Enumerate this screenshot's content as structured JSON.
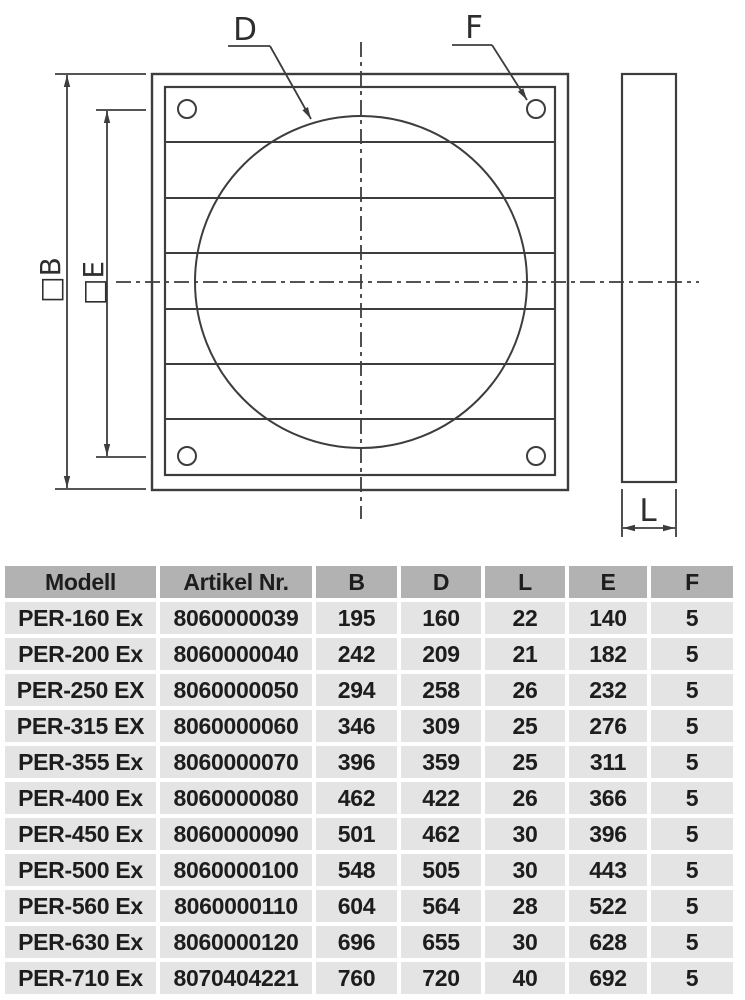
{
  "diagram": {
    "labels": {
      "d": "D",
      "f": "F",
      "b": "□B",
      "e": "□E",
      "l": "L"
    }
  },
  "table": {
    "headers": [
      "Modell",
      "Artikel Nr.",
      "B",
      "D",
      "L",
      "E",
      "F"
    ],
    "rows": [
      {
        "model": "PER-160 Ex",
        "artikel": "8060000039",
        "b": "195",
        "d": "160",
        "l": "22",
        "e": "140",
        "f": "5"
      },
      {
        "model": "PER-200 Ex",
        "artikel": "8060000040",
        "b": "242",
        "d": "209",
        "l": "21",
        "e": "182",
        "f": "5"
      },
      {
        "model": "PER-250 EX",
        "artikel": "8060000050",
        "b": "294",
        "d": "258",
        "l": "26",
        "e": "232",
        "f": "5"
      },
      {
        "model": "PER-315 EX",
        "artikel": "8060000060",
        "b": "346",
        "d": "309",
        "l": "25",
        "e": "276",
        "f": "5"
      },
      {
        "model": "PER-355 Ex",
        "artikel": "8060000070",
        "b": "396",
        "d": "359",
        "l": "25",
        "e": "311",
        "f": "5"
      },
      {
        "model": "PER-400 Ex",
        "artikel": "8060000080",
        "b": "462",
        "d": "422",
        "l": "26",
        "e": "366",
        "f": "5"
      },
      {
        "model": "PER-450 Ex",
        "artikel": "8060000090",
        "b": "501",
        "d": "462",
        "l": "30",
        "e": "396",
        "f": "5"
      },
      {
        "model": "PER-500 Ex",
        "artikel": "8060000100",
        "b": "548",
        "d": "505",
        "l": "30",
        "e": "443",
        "f": "5"
      },
      {
        "model": "PER-560 Ex",
        "artikel": "8060000110",
        "b": "604",
        "d": "564",
        "l": "28",
        "e": "522",
        "f": "5"
      },
      {
        "model": "PER-630 Ex",
        "artikel": "8060000120",
        "b": "696",
        "d": "655",
        "l": "30",
        "e": "628",
        "f": "5"
      },
      {
        "model": "PER-710 Ex",
        "artikel": "8070404221",
        "b": "760",
        "d": "720",
        "l": "40",
        "e": "692",
        "f": "5"
      }
    ]
  },
  "colors": {
    "line": "#3d3d3d",
    "table_header_bg": "#b2b2b2",
    "table_row_bg": "#e4e4e4",
    "text": "#1d1d1d"
  }
}
